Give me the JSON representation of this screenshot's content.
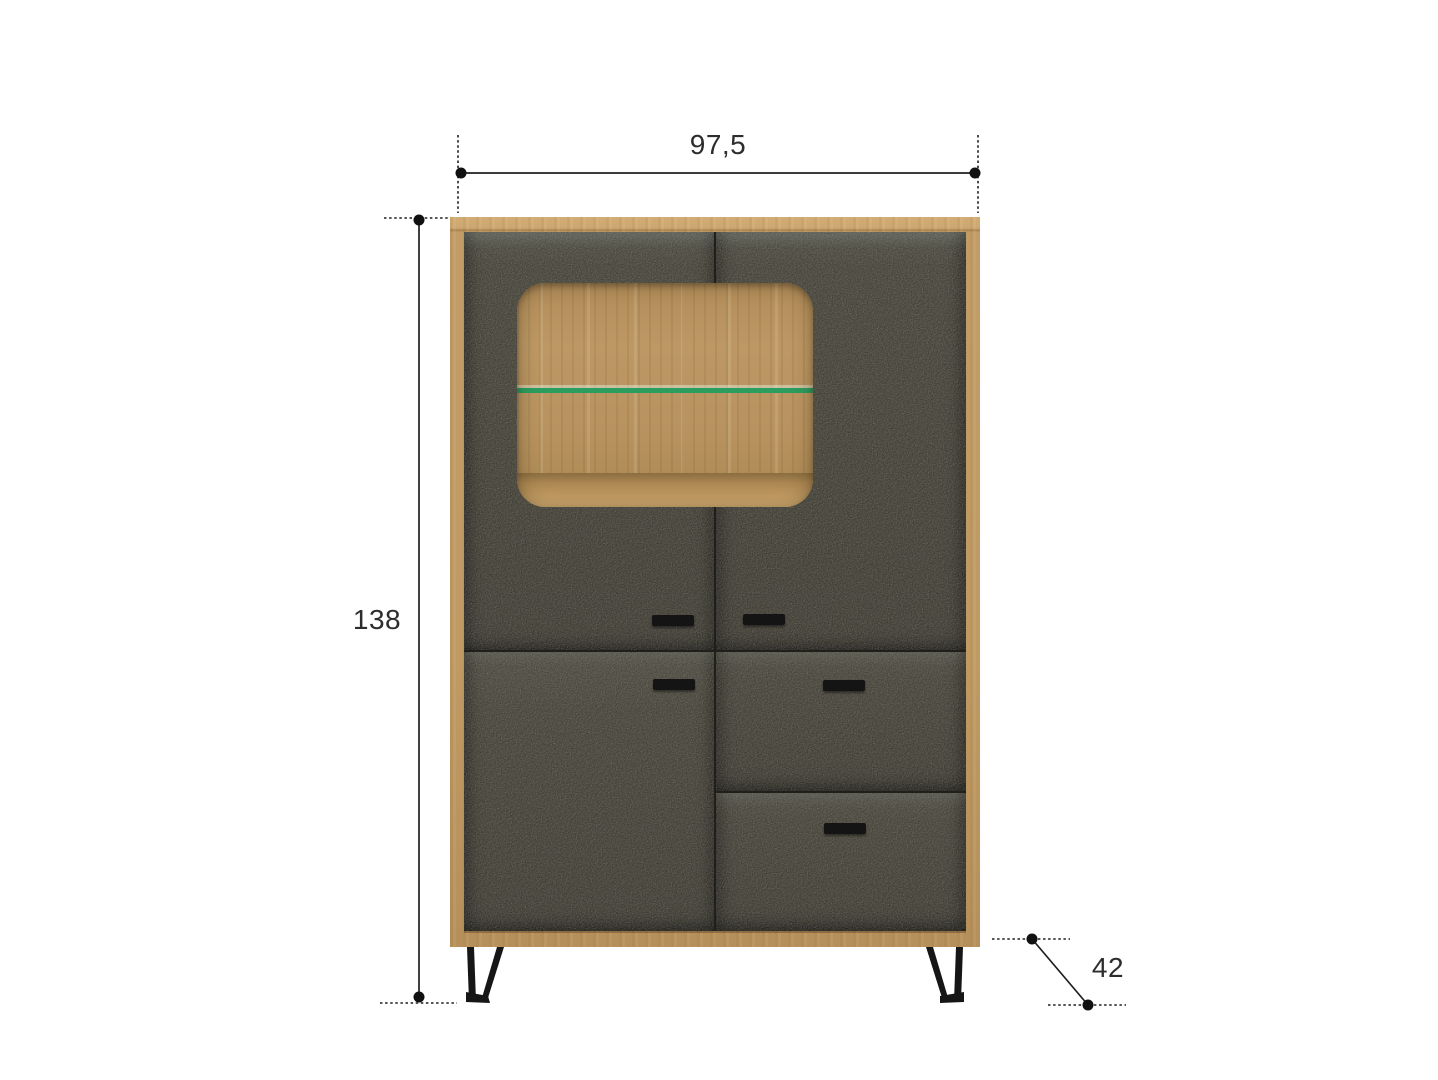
{
  "page": {
    "type": "furniture-dimension-diagram",
    "background": "#ffffff"
  },
  "dimensions": {
    "width": "97,5",
    "height": "138",
    "depth": "42"
  },
  "colors": {
    "wood_oak": "#c29c66",
    "wood_oak_light": "#d2ac74",
    "fabric_dark_grey": "#454238",
    "glass_shelf_green": "#2b9d5f",
    "metal_black": "#141414",
    "dimension_line": "#1f1f1f",
    "label_text": "#2d2d2d"
  },
  "cabinet": {
    "parts": {
      "frame": "oak-frame",
      "display_window": "glass-display-window",
      "shelf": "led-glass-shelf",
      "doors": [
        "top-left-door",
        "top-right-door",
        "bottom-left-door"
      ],
      "drawers": [
        "middle-right-drawer",
        "bottom-right-drawer"
      ],
      "legs": [
        "left-metal-leg",
        "right-metal-leg"
      ],
      "handles_count": 5
    }
  }
}
